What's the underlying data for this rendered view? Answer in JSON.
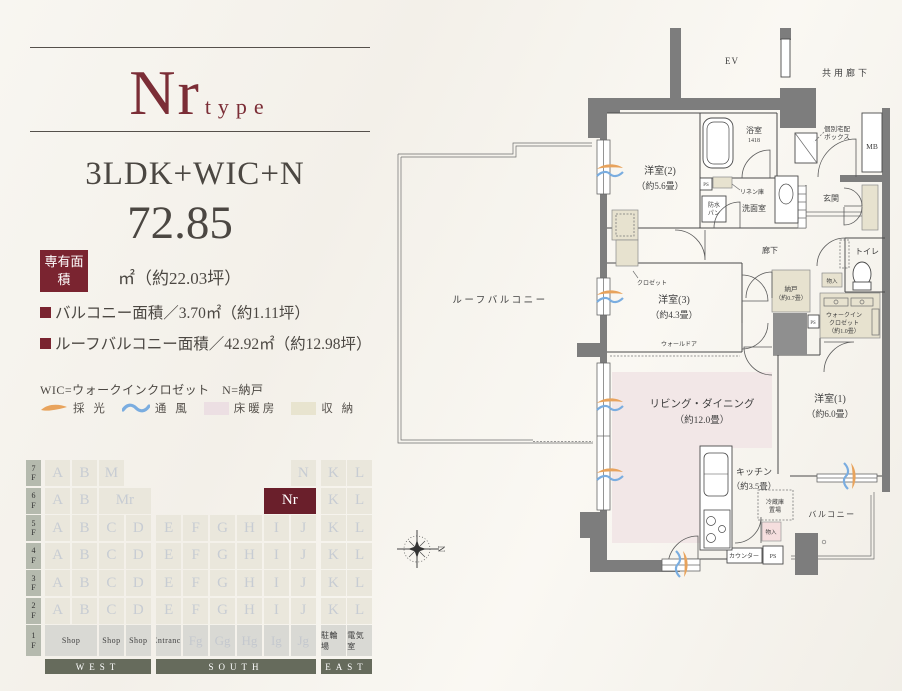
{
  "header": {
    "type_main": "Nr",
    "type_suffix": "type",
    "layout": "3LDK+WIC+N",
    "area_value": "72.85",
    "area_badge": "専有面積",
    "area_unit": "㎡（約22.03坪）",
    "bullet1": "バルコニー面積／3.70㎡（約1.11坪）",
    "bullet2": "ルーフバルコニー面積／42.92㎡（約12.98坪）",
    "note": "WIC=ウォークインクロゼット　N=納戸"
  },
  "legend": {
    "items": [
      {
        "icon": "daylight-swoosh",
        "label": "採 光",
        "color": "#e8a35c"
      },
      {
        "icon": "breeze-swoosh",
        "label": "通 風",
        "color": "#7aade0"
      },
      {
        "icon": "floor-heating-swatch",
        "label": "床暖房",
        "color": "#ecdfe3"
      },
      {
        "icon": "storage-swatch",
        "label": "収 納",
        "color": "#e8e4cf"
      }
    ]
  },
  "stack": {
    "floors": [
      {
        "label": "7F",
        "west": [
          {
            "t": "A",
            "c": 1
          },
          {
            "t": "B",
            "c": 2
          },
          {
            "t": "M",
            "c": 3
          }
        ],
        "south": [
          {
            "t": "N",
            "c": 6
          }
        ],
        "east": [
          {
            "t": "K",
            "c": 1
          },
          {
            "t": "L",
            "c": 2
          }
        ]
      },
      {
        "label": "6F",
        "west": [
          {
            "t": "A",
            "c": 1
          },
          {
            "t": "B",
            "c": 2
          },
          {
            "t": "Mr",
            "c": 3,
            "s": 2
          }
        ],
        "south": [
          {
            "t": "Nr",
            "c": 5,
            "s": 2,
            "k": "hl"
          }
        ],
        "east": [
          {
            "t": "K",
            "c": 1
          },
          {
            "t": "L",
            "c": 2
          }
        ]
      },
      {
        "label": "5F",
        "west": [
          {
            "t": "A",
            "c": 1
          },
          {
            "t": "B",
            "c": 2
          },
          {
            "t": "C",
            "c": 3
          },
          {
            "t": "D",
            "c": 4
          }
        ],
        "south": [
          {
            "t": "E",
            "c": 1
          },
          {
            "t": "F",
            "c": 2
          },
          {
            "t": "G",
            "c": 3
          },
          {
            "t": "H",
            "c": 4
          },
          {
            "t": "I",
            "c": 5
          },
          {
            "t": "J",
            "c": 6
          }
        ],
        "east": [
          {
            "t": "K",
            "c": 1
          },
          {
            "t": "L",
            "c": 2
          }
        ]
      },
      {
        "label": "4F",
        "west": [
          {
            "t": "A",
            "c": 1
          },
          {
            "t": "B",
            "c": 2
          },
          {
            "t": "C",
            "c": 3
          },
          {
            "t": "D",
            "c": 4
          }
        ],
        "south": [
          {
            "t": "E",
            "c": 1
          },
          {
            "t": "F",
            "c": 2
          },
          {
            "t": "G",
            "c": 3
          },
          {
            "t": "H",
            "c": 4
          },
          {
            "t": "I",
            "c": 5
          },
          {
            "t": "J",
            "c": 6
          }
        ],
        "east": [
          {
            "t": "K",
            "c": 1
          },
          {
            "t": "L",
            "c": 2
          }
        ]
      },
      {
        "label": "3F",
        "west": [
          {
            "t": "A",
            "c": 1
          },
          {
            "t": "B",
            "c": 2
          },
          {
            "t": "C",
            "c": 3
          },
          {
            "t": "D",
            "c": 4
          }
        ],
        "south": [
          {
            "t": "E",
            "c": 1
          },
          {
            "t": "F",
            "c": 2
          },
          {
            "t": "G",
            "c": 3
          },
          {
            "t": "H",
            "c": 4
          },
          {
            "t": "I",
            "c": 5
          },
          {
            "t": "J",
            "c": 6
          }
        ],
        "east": [
          {
            "t": "K",
            "c": 1
          },
          {
            "t": "L",
            "c": 2
          }
        ]
      },
      {
        "label": "2F",
        "west": [
          {
            "t": "A",
            "c": 1
          },
          {
            "t": "B",
            "c": 2
          },
          {
            "t": "C",
            "c": 3
          },
          {
            "t": "D",
            "c": 4
          }
        ],
        "south": [
          {
            "t": "E",
            "c": 1
          },
          {
            "t": "F",
            "c": 2
          },
          {
            "t": "G",
            "c": 3
          },
          {
            "t": "H",
            "c": 4
          },
          {
            "t": "I",
            "c": 5
          },
          {
            "t": "J",
            "c": 6
          }
        ],
        "east": [
          {
            "t": "K",
            "c": 1
          },
          {
            "t": "L",
            "c": 2
          }
        ]
      },
      {
        "label": "1F",
        "tall": true,
        "west": [
          {
            "t": "Shop",
            "c": 1,
            "s": 2,
            "k": "g"
          },
          {
            "t": "Shop",
            "c": 3,
            "k": "g"
          },
          {
            "t": "Shop",
            "c": 4,
            "k": "g"
          }
        ],
        "south": [
          {
            "t": "Entrance",
            "c": 1,
            "k": "g"
          },
          {
            "t": "Fg",
            "c": 2,
            "k": "gl"
          },
          {
            "t": "Gg",
            "c": 3,
            "k": "gl"
          },
          {
            "t": "Hg",
            "c": 4,
            "k": "gl"
          },
          {
            "t": "Ig",
            "c": 5,
            "k": "gl"
          },
          {
            "t": "Jg",
            "c": 6,
            "k": "gl"
          }
        ],
        "east": [
          {
            "t": "駐輪場",
            "c": 1,
            "k": "g"
          },
          {
            "t": "電気室",
            "c": 2,
            "k": "g"
          }
        ]
      }
    ],
    "directions": [
      "WEST",
      "SOUTH",
      "EAST"
    ],
    "highlight_unit": "Nr",
    "highlight_color": "#6a1f2b"
  },
  "plan": {
    "roof_balcony": "ルーフバルコニー",
    "ev": "EV",
    "common_corridor": "共用廊下",
    "delivery_box_1": "個別宅配",
    "delivery_box_2": "ボックス",
    "mb": "MB",
    "bedroom2_1": "洋室(2)",
    "bedroom2_2": "（約5.6畳）",
    "bath": "浴室",
    "bath_size": "1418",
    "waterproof_1": "防水",
    "waterproof_2": "パン",
    "linen": "リネン庫",
    "washroom": "洗面室",
    "entrance": "玄関",
    "hallway": "廊下",
    "bedroom3_1": "洋室(3)",
    "bedroom3_2": "（約4.3畳）",
    "closet": "クロゼット",
    "wall_door": "ウォールドア",
    "nando_1": "納戸",
    "nando_2": "（約0.7畳）",
    "monoire": "物入",
    "toilet": "トイレ",
    "wic_1": "ウォークイン",
    "wic_2": "クロゼット",
    "wic_3": "（約1.0畳）",
    "bedroom1_1": "洋室(1)",
    "bedroom1_2": "（約6.0畳）",
    "ld_1": "リビング・ダイニング",
    "ld_2": "（約12.0畳）",
    "kitchen_1": "キッチン",
    "kitchen_2": "（約3.5畳）",
    "fridge_1": "冷蔵庫",
    "fridge_2": "置場",
    "counter": "カウンター",
    "ps": "PS",
    "balcony": "バルコニー",
    "compass_n": "N"
  },
  "colors": {
    "accent_maroon": "#7a2430",
    "highlight_cell": "#6a1f2b",
    "floor_heating_pink": "#f2e7e7",
    "storage_beige": "#e7e2cf",
    "wall_gray": "#7d7d7d",
    "daylight_orange": "#e8a35c",
    "breeze_blue": "#7aade0"
  }
}
